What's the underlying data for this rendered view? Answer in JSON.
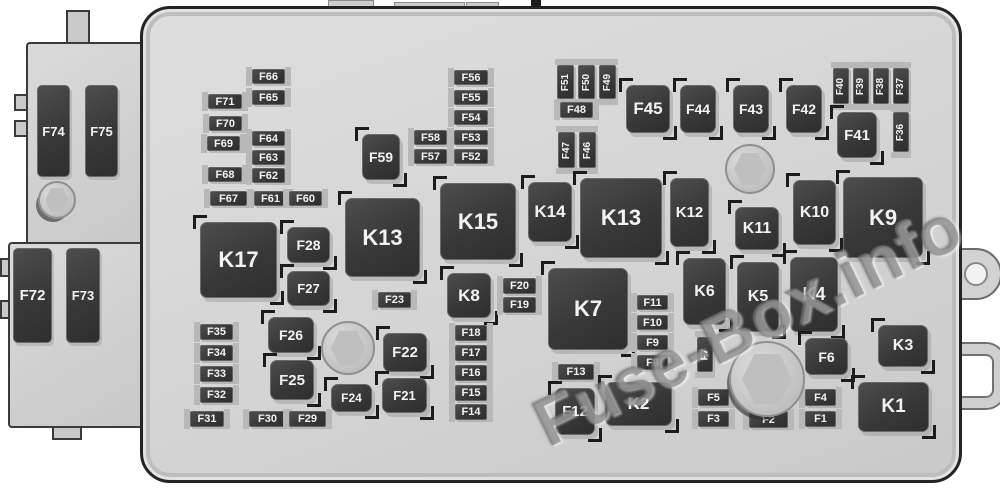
{
  "watermark": {
    "text": "Fuse-Box.info"
  },
  "colors": {
    "background": "#ffffff",
    "box_fill": "#d4d4d4",
    "box_border": "#242424",
    "block_fill": "#3a3a3a",
    "block_text": "#f2f2f2",
    "rail": "#b8b8b8",
    "bolt": "#bfbfbf"
  },
  "board": {
    "elements": [
      {
        "id": "F74",
        "label": "F74",
        "kind": "cart",
        "x": 37,
        "y": 85,
        "w": 33,
        "h": 92
      },
      {
        "id": "F75",
        "label": "F75",
        "kind": "cart",
        "x": 85,
        "y": 85,
        "w": 33,
        "h": 92
      },
      {
        "id": "F72",
        "label": "F72",
        "kind": "cart",
        "x": 13,
        "y": 248,
        "w": 39,
        "h": 95
      },
      {
        "id": "F73",
        "label": "F73",
        "kind": "cart",
        "x": 66,
        "y": 248,
        "w": 34,
        "h": 95
      },
      {
        "id": "F66",
        "label": "F66",
        "kind": "fuse",
        "x": 252,
        "y": 69,
        "w": 33,
        "h": 15
      },
      {
        "id": "F65",
        "label": "F65",
        "kind": "fuse",
        "x": 252,
        "y": 90,
        "w": 33,
        "h": 15
      },
      {
        "id": "F71",
        "label": "F71",
        "kind": "fuse",
        "x": 208,
        "y": 94,
        "w": 34,
        "h": 15
      },
      {
        "id": "F70",
        "label": "F70",
        "kind": "fuse",
        "x": 209,
        "y": 116,
        "w": 33,
        "h": 15
      },
      {
        "id": "F69",
        "label": "F69",
        "kind": "fuse",
        "x": 207,
        "y": 136,
        "w": 33,
        "h": 15
      },
      {
        "id": "F64",
        "label": "F64",
        "kind": "fuse",
        "x": 252,
        "y": 131,
        "w": 33,
        "h": 15
      },
      {
        "id": "F63",
        "label": "F63",
        "kind": "fuse",
        "x": 252,
        "y": 150,
        "w": 33,
        "h": 15
      },
      {
        "id": "F68",
        "label": "F68",
        "kind": "fuse",
        "x": 208,
        "y": 167,
        "w": 34,
        "h": 15
      },
      {
        "id": "F62",
        "label": "F62",
        "kind": "fuse",
        "x": 252,
        "y": 168,
        "w": 33,
        "h": 15
      },
      {
        "id": "F67",
        "label": "F67",
        "kind": "fuse",
        "x": 210,
        "y": 191,
        "w": 37,
        "h": 15
      },
      {
        "id": "F61",
        "label": "F61",
        "kind": "fuse",
        "x": 254,
        "y": 191,
        "w": 33,
        "h": 15
      },
      {
        "id": "F60",
        "label": "F60",
        "kind": "fuse",
        "x": 289,
        "y": 191,
        "w": 33,
        "h": 15
      },
      {
        "id": "F59",
        "label": "F59",
        "kind": "relay",
        "x": 362,
        "y": 134,
        "w": 38,
        "h": 46
      },
      {
        "id": "F58",
        "label": "F58",
        "kind": "fuse",
        "x": 414,
        "y": 130,
        "w": 33,
        "h": 15
      },
      {
        "id": "F57",
        "label": "F57",
        "kind": "fuse",
        "x": 414,
        "y": 149,
        "w": 33,
        "h": 15
      },
      {
        "id": "F56",
        "label": "F56",
        "kind": "fuse",
        "x": 454,
        "y": 70,
        "w": 34,
        "h": 15
      },
      {
        "id": "F55",
        "label": "F55",
        "kind": "fuse",
        "x": 454,
        "y": 90,
        "w": 34,
        "h": 15
      },
      {
        "id": "F54",
        "label": "F54",
        "kind": "fuse",
        "x": 454,
        "y": 110,
        "w": 34,
        "h": 15
      },
      {
        "id": "F53",
        "label": "F53",
        "kind": "fuse",
        "x": 454,
        "y": 130,
        "w": 34,
        "h": 15
      },
      {
        "id": "F52",
        "label": "F52",
        "kind": "fuse",
        "x": 454,
        "y": 149,
        "w": 34,
        "h": 15
      },
      {
        "id": "F51",
        "label": "F51",
        "kind": "fusev",
        "x": 557,
        "y": 65,
        "w": 17,
        "h": 34
      },
      {
        "id": "F50",
        "label": "F50",
        "kind": "fusev",
        "x": 578,
        "y": 65,
        "w": 17,
        "h": 34
      },
      {
        "id": "F49",
        "label": "F49",
        "kind": "fusev",
        "x": 599,
        "y": 65,
        "w": 17,
        "h": 34
      },
      {
        "id": "F48",
        "label": "F48",
        "kind": "fuse",
        "x": 560,
        "y": 102,
        "w": 33,
        "h": 16
      },
      {
        "id": "F47",
        "label": "F47",
        "kind": "fusev",
        "x": 558,
        "y": 132,
        "w": 17,
        "h": 36
      },
      {
        "id": "F46",
        "label": "F46",
        "kind": "fusev",
        "x": 579,
        "y": 132,
        "w": 17,
        "h": 36
      },
      {
        "id": "F45",
        "label": "F45",
        "kind": "relay",
        "x": 626,
        "y": 85,
        "w": 44,
        "h": 48
      },
      {
        "id": "F44",
        "label": "F44",
        "kind": "relay",
        "x": 680,
        "y": 85,
        "w": 36,
        "h": 48
      },
      {
        "id": "F43",
        "label": "F43",
        "kind": "relay",
        "x": 733,
        "y": 85,
        "w": 36,
        "h": 48
      },
      {
        "id": "F42",
        "label": "F42",
        "kind": "relay",
        "x": 786,
        "y": 85,
        "w": 36,
        "h": 48
      },
      {
        "id": "F40",
        "label": "F40",
        "kind": "fusev",
        "x": 833,
        "y": 68,
        "w": 16,
        "h": 36
      },
      {
        "id": "F39",
        "label": "F39",
        "kind": "fusev",
        "x": 853,
        "y": 68,
        "w": 16,
        "h": 36
      },
      {
        "id": "F38",
        "label": "F38",
        "kind": "fusev",
        "x": 873,
        "y": 68,
        "w": 16,
        "h": 36
      },
      {
        "id": "F37",
        "label": "F37",
        "kind": "fusev",
        "x": 893,
        "y": 68,
        "w": 16,
        "h": 36
      },
      {
        "id": "F41",
        "label": "F41",
        "kind": "relay",
        "x": 837,
        "y": 112,
        "w": 40,
        "h": 46
      },
      {
        "id": "F36",
        "label": "F36",
        "kind": "fusev",
        "x": 893,
        "y": 112,
        "w": 16,
        "h": 40
      },
      {
        "id": "K17",
        "label": "K17",
        "kind": "relay",
        "x": 200,
        "y": 222,
        "w": 77,
        "h": 76
      },
      {
        "id": "F28",
        "label": "F28",
        "kind": "relay",
        "x": 287,
        "y": 227,
        "w": 43,
        "h": 36
      },
      {
        "id": "F27",
        "label": "F27",
        "kind": "relay",
        "x": 287,
        "y": 271,
        "w": 43,
        "h": 35
      },
      {
        "id": "K13a",
        "label": "K13",
        "kind": "relay",
        "x": 345,
        "y": 198,
        "w": 75,
        "h": 79
      },
      {
        "id": "F23",
        "label": "F23",
        "kind": "fuse",
        "x": 378,
        "y": 292,
        "w": 33,
        "h": 16
      },
      {
        "id": "K15",
        "label": "K15",
        "kind": "relay",
        "x": 440,
        "y": 183,
        "w": 76,
        "h": 77
      },
      {
        "id": "K8",
        "label": "K8",
        "kind": "relay",
        "x": 447,
        "y": 273,
        "w": 44,
        "h": 45
      },
      {
        "id": "F20",
        "label": "F20",
        "kind": "fuse",
        "x": 503,
        "y": 278,
        "w": 33,
        "h": 16
      },
      {
        "id": "F19",
        "label": "F19",
        "kind": "fuse",
        "x": 503,
        "y": 297,
        "w": 33,
        "h": 16
      },
      {
        "id": "K14",
        "label": "K14",
        "kind": "relay",
        "x": 528,
        "y": 182,
        "w": 44,
        "h": 60
      },
      {
        "id": "K13b",
        "label": "K13",
        "kind": "relay",
        "x": 580,
        "y": 178,
        "w": 82,
        "h": 80
      },
      {
        "id": "K12",
        "label": "K12",
        "kind": "relay",
        "x": 670,
        "y": 178,
        "w": 39,
        "h": 69
      },
      {
        "id": "K11",
        "label": "K11",
        "kind": "relay",
        "x": 735,
        "y": 207,
        "w": 44,
        "h": 43
      },
      {
        "id": "K10",
        "label": "K10",
        "kind": "relay",
        "x": 793,
        "y": 180,
        "w": 43,
        "h": 65
      },
      {
        "id": "K9",
        "label": "K9",
        "kind": "relay",
        "x": 843,
        "y": 177,
        "w": 80,
        "h": 81
      },
      {
        "id": "F35",
        "label": "F35",
        "kind": "fuse",
        "x": 200,
        "y": 324,
        "w": 33,
        "h": 16
      },
      {
        "id": "F34",
        "label": "F34",
        "kind": "fuse",
        "x": 200,
        "y": 345,
        "w": 33,
        "h": 16
      },
      {
        "id": "F33",
        "label": "F33",
        "kind": "fuse",
        "x": 200,
        "y": 366,
        "w": 33,
        "h": 16
      },
      {
        "id": "F32",
        "label": "F32",
        "kind": "fuse",
        "x": 200,
        "y": 387,
        "w": 33,
        "h": 16
      },
      {
        "id": "F31",
        "label": "F31",
        "kind": "fuse",
        "x": 190,
        "y": 411,
        "w": 34,
        "h": 16
      },
      {
        "id": "F26",
        "label": "F26",
        "kind": "relay",
        "x": 268,
        "y": 317,
        "w": 46,
        "h": 36
      },
      {
        "id": "F25",
        "label": "F25",
        "kind": "relay",
        "x": 270,
        "y": 360,
        "w": 44,
        "h": 40
      },
      {
        "id": "F30",
        "label": "F30",
        "kind": "fuse",
        "x": 249,
        "y": 411,
        "w": 37,
        "h": 16
      },
      {
        "id": "F29",
        "label": "F29",
        "kind": "fuse",
        "x": 289,
        "y": 411,
        "w": 37,
        "h": 16
      },
      {
        "id": "F24",
        "label": "F24",
        "kind": "relay",
        "x": 331,
        "y": 384,
        "w": 41,
        "h": 28
      },
      {
        "id": "F22",
        "label": "F22",
        "kind": "relay",
        "x": 383,
        "y": 333,
        "w": 44,
        "h": 39
      },
      {
        "id": "F21",
        "label": "F21",
        "kind": "relay",
        "x": 382,
        "y": 378,
        "w": 45,
        "h": 35
      },
      {
        "id": "F18",
        "label": "F18",
        "kind": "fuse",
        "x": 455,
        "y": 325,
        "w": 32,
        "h": 16
      },
      {
        "id": "F17",
        "label": "F17",
        "kind": "fuse",
        "x": 455,
        "y": 345,
        "w": 32,
        "h": 16
      },
      {
        "id": "F16",
        "label": "F16",
        "kind": "fuse",
        "x": 455,
        "y": 365,
        "w": 32,
        "h": 16
      },
      {
        "id": "F15",
        "label": "F15",
        "kind": "fuse",
        "x": 455,
        "y": 385,
        "w": 32,
        "h": 16
      },
      {
        "id": "F14",
        "label": "F14",
        "kind": "fuse",
        "x": 455,
        "y": 404,
        "w": 32,
        "h": 16
      },
      {
        "id": "K7",
        "label": "K7",
        "kind": "relay",
        "x": 548,
        "y": 268,
        "w": 80,
        "h": 82
      },
      {
        "id": "F13",
        "label": "F13",
        "kind": "fuse",
        "x": 558,
        "y": 364,
        "w": 36,
        "h": 16
      },
      {
        "id": "F12",
        "label": "F12",
        "kind": "relay",
        "x": 555,
        "y": 388,
        "w": 40,
        "h": 47
      },
      {
        "id": "K2",
        "label": "K2",
        "kind": "relay",
        "x": 605,
        "y": 382,
        "w": 67,
        "h": 44
      },
      {
        "id": "F11",
        "label": "F11",
        "kind": "fuse",
        "x": 637,
        "y": 295,
        "w": 31,
        "h": 15
      },
      {
        "id": "F10",
        "label": "F10",
        "kind": "fuse",
        "x": 637,
        "y": 315,
        "w": 31,
        "h": 15
      },
      {
        "id": "F9",
        "label": "F9",
        "kind": "fuse",
        "x": 637,
        "y": 335,
        "w": 31,
        "h": 15
      },
      {
        "id": "F8",
        "label": "F8",
        "kind": "fuse",
        "x": 637,
        "y": 355,
        "w": 31,
        "h": 15
      },
      {
        "id": "K6",
        "label": "K6",
        "kind": "relay",
        "x": 683,
        "y": 258,
        "w": 43,
        "h": 67
      },
      {
        "id": "F7",
        "label": "F7",
        "kind": "fusev",
        "x": 697,
        "y": 337,
        "w": 16,
        "h": 35
      },
      {
        "id": "K5",
        "label": "K5",
        "kind": "relay",
        "x": 737,
        "y": 262,
        "w": 42,
        "h": 70
      },
      {
        "id": "K4",
        "label": "K4",
        "kind": "relay",
        "x": 790,
        "y": 257,
        "w": 48,
        "h": 75
      },
      {
        "id": "F6",
        "label": "F6",
        "kind": "relay",
        "x": 805,
        "y": 338,
        "w": 43,
        "h": 37
      },
      {
        "id": "F5",
        "label": "F5",
        "kind": "fuse",
        "x": 698,
        "y": 389,
        "w": 31,
        "h": 17
      },
      {
        "id": "F4",
        "label": "F4",
        "kind": "fuse",
        "x": 805,
        "y": 389,
        "w": 31,
        "h": 17
      },
      {
        "id": "F3",
        "label": "F3",
        "kind": "fuse",
        "x": 698,
        "y": 411,
        "w": 31,
        "h": 16
      },
      {
        "id": "F2",
        "label": "F2",
        "kind": "fuse",
        "x": 749,
        "y": 411,
        "w": 39,
        "h": 17
      },
      {
        "id": "F1",
        "label": "F1",
        "kind": "fuse",
        "x": 805,
        "y": 411,
        "w": 31,
        "h": 16
      },
      {
        "id": "K3",
        "label": "K3",
        "kind": "relay",
        "x": 878,
        "y": 325,
        "w": 50,
        "h": 42
      },
      {
        "id": "K1",
        "label": "K1",
        "kind": "relay",
        "x": 858,
        "y": 382,
        "w": 71,
        "h": 50
      }
    ],
    "bolts": [
      {
        "id": "bolt-left-module",
        "cx": 55,
        "cy": 198,
        "r": 17,
        "accent": true
      },
      {
        "id": "bolt-lower-center",
        "cx": 346,
        "cy": 346,
        "r": 25,
        "accent": false
      },
      {
        "id": "bolt-upper-right",
        "cx": 748,
        "cy": 167,
        "r": 23,
        "accent": false
      },
      {
        "id": "bolt-lower-right",
        "cx": 765,
        "cy": 377,
        "r": 36,
        "accent": true
      }
    ]
  }
}
